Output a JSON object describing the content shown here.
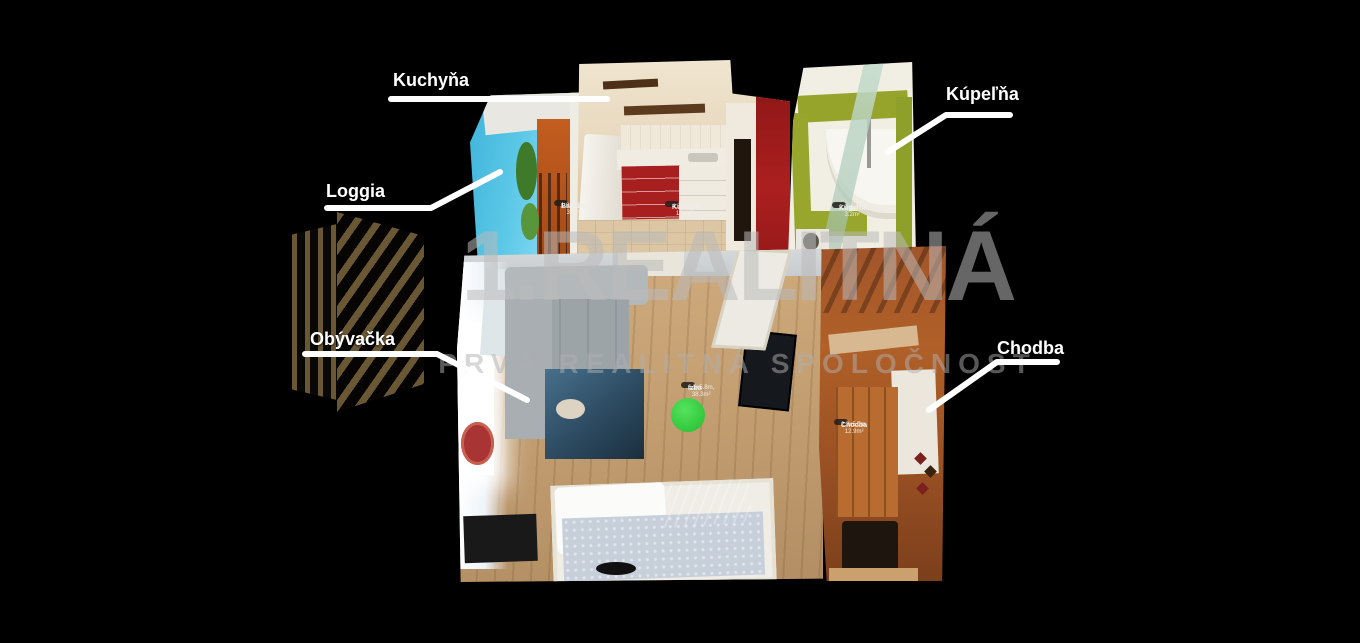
{
  "background": "#000000",
  "watermark": {
    "title": "1.REALITNÁ",
    "subtitle": "PRVÁ REALITNÁ SPOLOČNOSŤ"
  },
  "labels": {
    "kuchyna": "Kuchyňa",
    "kupelna": "Kúpeľňa",
    "loggia": "Loggia",
    "obyvacka": "Obývačka",
    "chodba": "Chodba"
  },
  "badges": {
    "balkon": {
      "name": "Balkón",
      "dims": "1.0x3.3m, 3.3m²"
    },
    "kuchyna": {
      "name": "Kuchyňa",
      "dims": "4.3x4.2m, 12.4m²"
    },
    "kupelna": {
      "name": "Kúpeľňa",
      "dims": "2.0x1.6m, 3.2m²"
    },
    "izba": {
      "name": "Izba",
      "dims": "6.5x5.8m, 38.3m²"
    },
    "chodba": {
      "name": "Chodba",
      "dims": "2.3x5.0m, 12.9m²"
    }
  },
  "colors": {
    "label_text": "#ffffff",
    "callout_line": "#ffffff",
    "watermark": "#bababa",
    "logo_gold": "#6a5734",
    "marker_green": "#2fd33a",
    "bathroom_olive": "#97a42c",
    "kitchen_red": "#a81f1f",
    "hallway_wood": "#a2552a",
    "floor_wood": "#c29e71",
    "sky_blue": "#5ec9e8"
  }
}
